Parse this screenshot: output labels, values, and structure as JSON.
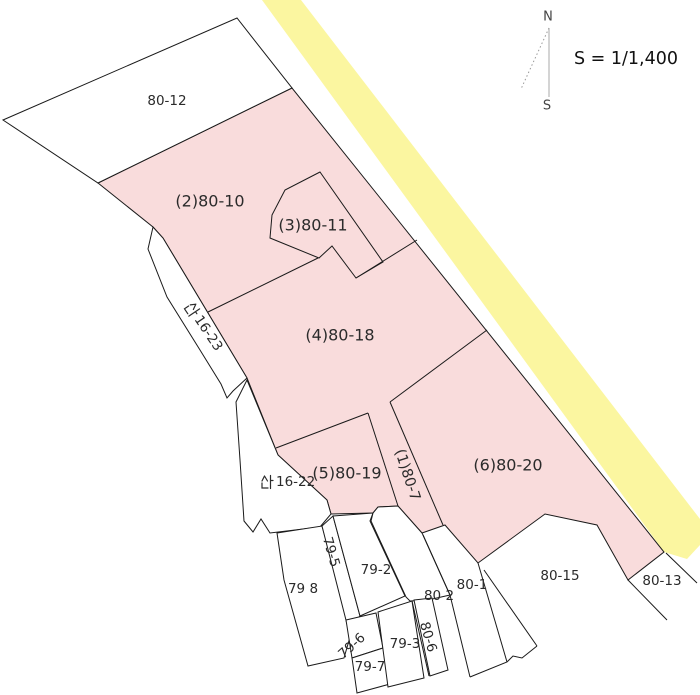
{
  "map": {
    "scale_label": "S = 1/1,400",
    "compass": {
      "north_label": "N",
      "south_label": "S"
    },
    "colors": {
      "highlight_parcel_fill": "#F9DCDC",
      "road_fill": "#FBF6A0",
      "boundary_line": "#1A1A1A",
      "label_text": "#2B2B2B"
    },
    "parcels": [
      {
        "id": "80-12",
        "label": "80-12",
        "fill": "white"
      },
      {
        "id": "80-10",
        "label": "(2)80-10",
        "fill": "pink"
      },
      {
        "id": "80-11",
        "label": "(3)80-11",
        "fill": "pink"
      },
      {
        "id": "80-18",
        "label": "(4)80-18",
        "fill": "pink"
      },
      {
        "id": "80-19",
        "label": "(5)80-19",
        "fill": "pink"
      },
      {
        "id": "80-7",
        "label": "(1)80-7",
        "fill": "pink",
        "rotated": true
      },
      {
        "id": "80-20",
        "label": "(6)80-20",
        "fill": "pink"
      },
      {
        "id": "san16-23",
        "label": "산16-23",
        "label_suffix": "16-23",
        "fill": "white",
        "rotated": true
      },
      {
        "id": "san16-22",
        "label": "산16-22",
        "label_suffix": "16-22",
        "fill": "white"
      },
      {
        "id": "79-5",
        "label": "79-5",
        "fill": "white",
        "rotated": true
      },
      {
        "id": "79-8",
        "label": "79 8",
        "fill": "white"
      },
      {
        "id": "79-2",
        "label": "79-2",
        "fill": "white"
      },
      {
        "id": "80-2",
        "label": "80 2",
        "fill": "white"
      },
      {
        "id": "80-1",
        "label": "80-1",
        "fill": "white"
      },
      {
        "id": "79-6",
        "label": "79-6",
        "fill": "white",
        "rotated": true
      },
      {
        "id": "79-7",
        "label": "79-7",
        "fill": "white"
      },
      {
        "id": "79-3",
        "label": "79-3",
        "fill": "white"
      },
      {
        "id": "80-6",
        "label": "80-6",
        "fill": "white",
        "rotated": true
      },
      {
        "id": "80-15",
        "label": "80-15",
        "fill": "white"
      },
      {
        "id": "80-13",
        "label": "80-13",
        "fill": "white"
      }
    ]
  }
}
